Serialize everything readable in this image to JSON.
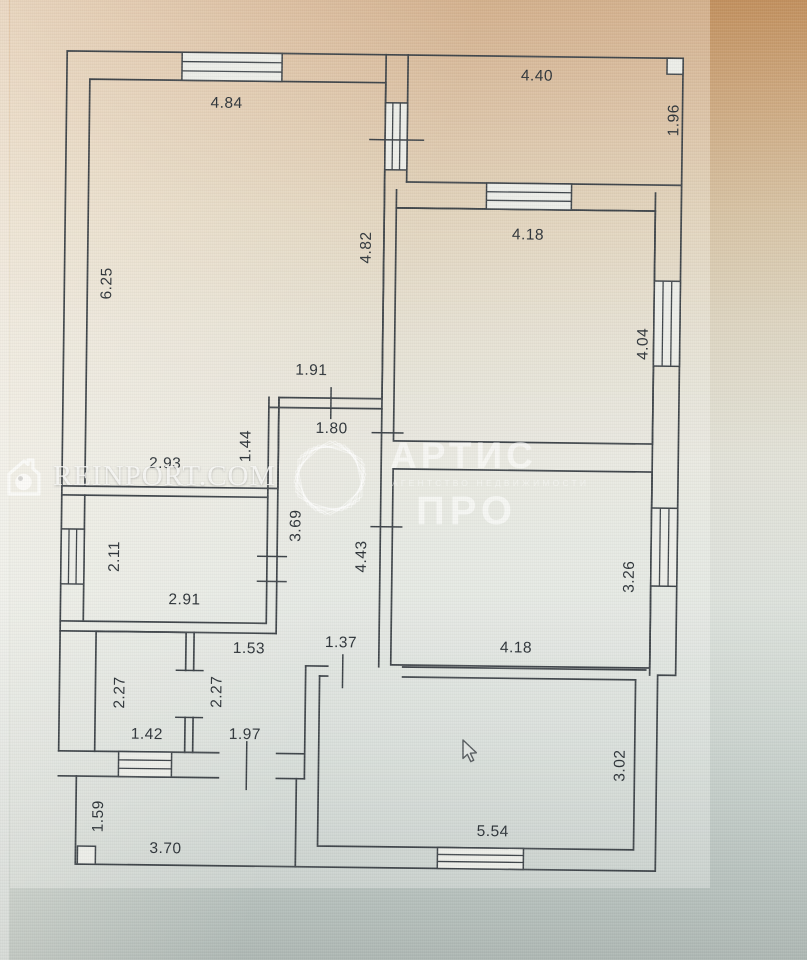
{
  "watermarks": {
    "reinport": {
      "text": "REINPORT.COM",
      "icon": "house-camera-icon"
    },
    "artis": {
      "name": "АРТИС",
      "tagline": "АГЕНТСТВО НЕДВИЖИМОСТИ",
      "suffix": "ПРО",
      "icon": "hexagon-spirograph-logo"
    }
  },
  "floor_plan": {
    "type": "apartment-floor-plan",
    "units": "m",
    "line_color": "#40464b",
    "dimension_labels": [
      {
        "text": "4.84",
        "x": 222,
        "y": 105,
        "rot": 0
      },
      {
        "text": "4.40",
        "x": 532,
        "y": 74,
        "rot": 0
      },
      {
        "text": "1.96",
        "x": 669,
        "y": 117,
        "rot": -90
      },
      {
        "text": "6.25",
        "x": 104,
        "y": 287,
        "rot": -90
      },
      {
        "text": "4.82",
        "x": 363,
        "y": 248,
        "rot": -90
      },
      {
        "text": "4.18",
        "x": 525,
        "y": 233,
        "rot": 0
      },
      {
        "text": "4.04",
        "x": 641,
        "y": 341,
        "rot": -90
      },
      {
        "text": "1.91",
        "x": 310,
        "y": 371,
        "rot": 0
      },
      {
        "text": "1.80",
        "x": 331,
        "y": 429,
        "rot": 0
      },
      {
        "text": "1.44",
        "x": 245,
        "y": 448,
        "rot": -90
      },
      {
        "text": "2.93",
        "x": 165,
        "y": 466,
        "rot": 0
      },
      {
        "text": "3.69",
        "x": 296,
        "y": 527,
        "rot": -90
      },
      {
        "text": "4.43",
        "x": 362,
        "y": 557,
        "rot": -90
      },
      {
        "text": "2.11",
        "x": 115,
        "y": 560,
        "rot": -90
      },
      {
        "text": "2.91",
        "x": 186,
        "y": 602,
        "rot": 0
      },
      {
        "text": "3.26",
        "x": 630,
        "y": 574,
        "rot": -90
      },
      {
        "text": "4.18",
        "x": 518,
        "y": 646,
        "rot": 0
      },
      {
        "text": "1.53",
        "x": 251,
        "y": 650,
        "rot": 0
      },
      {
        "text": "1.37",
        "x": 343,
        "y": 643,
        "rot": 0
      },
      {
        "text": "2.27",
        "x": 122,
        "y": 696,
        "rot": -90
      },
      {
        "text": "2.27",
        "x": 219,
        "y": 694,
        "rot": -90
      },
      {
        "text": "1.42",
        "x": 150,
        "y": 737,
        "rot": 0
      },
      {
        "text": "1.97",
        "x": 248,
        "y": 736,
        "rot": 0
      },
      {
        "text": "3.02",
        "x": 623,
        "y": 763,
        "rot": -90
      },
      {
        "text": "5.54",
        "x": 497,
        "y": 830,
        "rot": 0
      },
      {
        "text": "1.59",
        "x": 102,
        "y": 820,
        "rot": -90
      },
      {
        "text": "3.70",
        "x": 170,
        "y": 851,
        "rot": 0
      }
    ]
  },
  "cursor": {
    "icon": "arrow-pointer"
  }
}
